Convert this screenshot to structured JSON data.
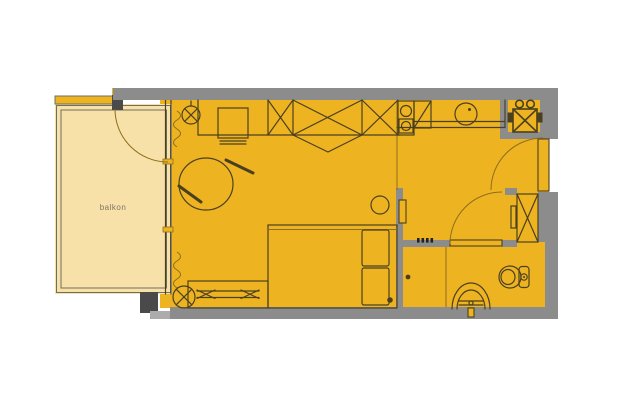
{
  "plan": {
    "room_labels": {
      "balcony": "balkon"
    },
    "colors": {
      "background": "#FFFFFF",
      "floor": "#EEB321",
      "balcony": "#F8E1A8",
      "balcony_line": "#6F6F5F",
      "wall": "#8C8C8C",
      "wall_dark": "#4A4A4A",
      "wall_step": "#ACACAC",
      "line": "#4A4020",
      "line_soft": "#8D6E1E",
      "label": "#7B7668"
    },
    "fixtures": [
      "balcony-door",
      "curtains",
      "ceiling-lamp",
      "desk",
      "wardrobe",
      "round-table-with-chairs",
      "stool",
      "bed",
      "pillows",
      "radiator",
      "floor-lamp",
      "kitchen-counter",
      "stove",
      "kitchen-sink",
      "washing-machine",
      "entrance-door",
      "hall-closet",
      "wall-mirror",
      "bathroom-door",
      "shower-partition",
      "toilet",
      "washbasin"
    ]
  }
}
